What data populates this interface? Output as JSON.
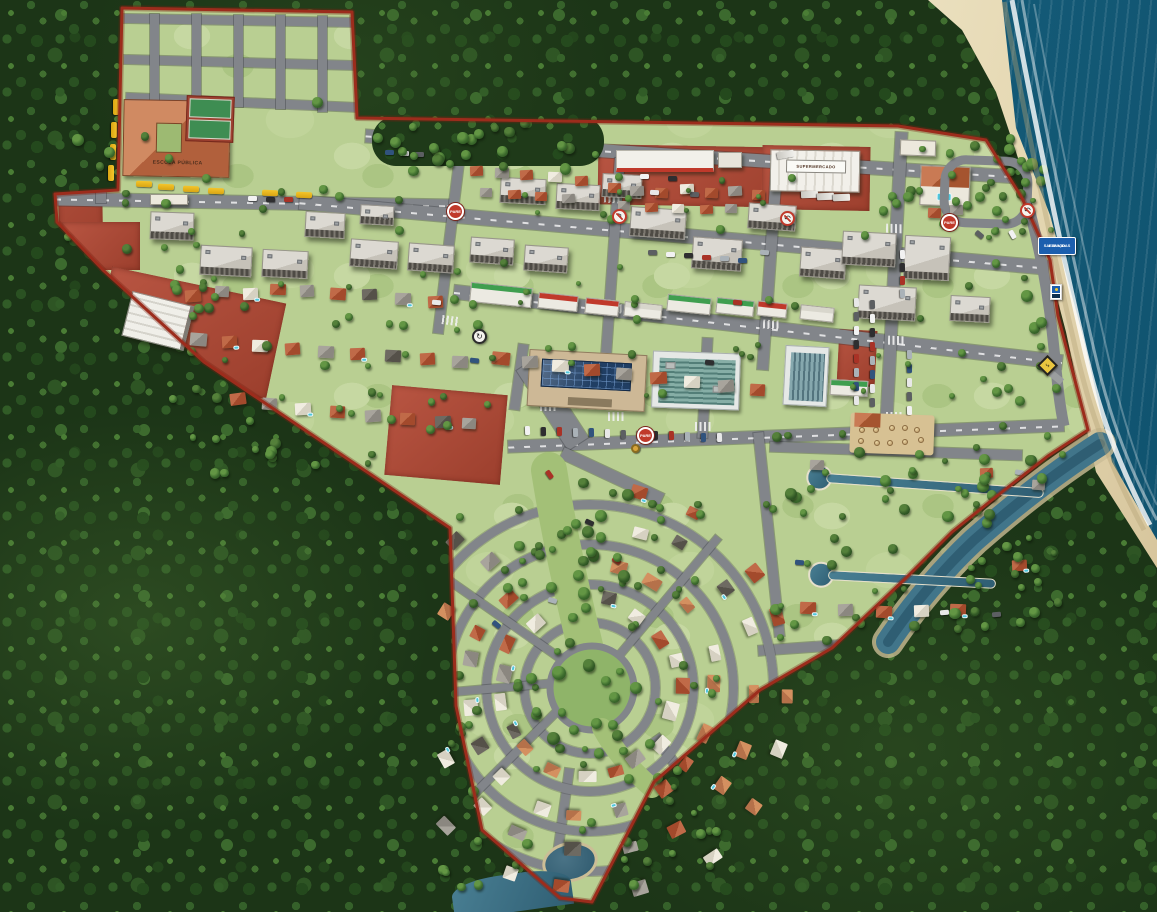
{
  "meta": {
    "description": "Aerial 3D masterplan rendering of a coastal planned neighborhood bounded by a red property line, surrounded by dense forest, with a beach and ocean on the right and a river mouth to the southeast.",
    "width": 1157,
    "height": 912
  },
  "palette": {
    "forest": "#1c3517",
    "lawn": "#b9cf92",
    "road": "#82858a",
    "boundary": "#9c2c1c",
    "red_lot": "#ad4a37",
    "ocean": "#1d6e88",
    "sand": "#e2d6b0",
    "water": "#3c7086",
    "stop_red": "#c0392b",
    "info_blue": "#1c5fae",
    "warning_yellow": "#e9c53f",
    "bus_yellow": "#f4c52b",
    "solar_blue": "#203e63"
  },
  "labels": {
    "school_roof": "ESCOLA PÚBLICA",
    "market_roof": "SUPERMERCADO",
    "stop_sign": "PARE",
    "beach_info_line1": "ESPAÇO",
    "beach_info_line2": "SALVA-VIDAS"
  },
  "icons": {
    "no_left_turn": "↰",
    "no_u_turn": "↶",
    "roundabout": "↻",
    "beach_warning": "⤷"
  },
  "map": {
    "roof_colors": [
      [
        "#c06a48",
        "#a34a2c"
      ],
      [
        "#a8a49c",
        "#8b8780"
      ],
      [
        "#f0ece0",
        "#d6d1c2"
      ],
      [
        "#6e6a62",
        "#555149"
      ],
      [
        "#d49060",
        "#b5714a"
      ]
    ],
    "car_colors": [
      "#f2f2f2",
      "#2e2e30",
      "#a93226",
      "#aab2b8",
      "#31537d",
      "#e8e8e8",
      "#5c5f62"
    ],
    "shop_sign_colors": {
      "g": "#3f9e4f",
      "r": "#c0392b",
      "w": "#d8d6cc"
    },
    "red_lots": [
      [
        598,
        146,
        206,
        60,
        1
      ],
      [
        762,
        146,
        108,
        64,
        1
      ],
      [
        58,
        94,
        44,
        170,
        -1
      ],
      [
        62,
        222,
        78,
        48,
        0
      ],
      [
        100,
        284,
        178,
        98,
        12
      ],
      [
        388,
        390,
        116,
        90,
        5
      ],
      [
        838,
        330,
        38,
        56,
        3
      ]
    ],
    "roads": [
      [
        124,
        16,
        230,
        9,
        1,
        0
      ],
      [
        124,
        58,
        232,
        9,
        1.5,
        0
      ],
      [
        126,
        98,
        236,
        9,
        2.5,
        0
      ],
      [
        55,
        196,
        398,
        13,
        1,
        1
      ],
      [
        150,
        14,
        9,
        92,
        0,
        0
      ],
      [
        192,
        14,
        9,
        92,
        0,
        0
      ],
      [
        234,
        15,
        9,
        92,
        0,
        0
      ],
      [
        276,
        15,
        9,
        94,
        0,
        0
      ],
      [
        318,
        16,
        9,
        96,
        0,
        0
      ],
      [
        96,
        95,
        10,
        108,
        0,
        0
      ],
      [
        365,
        150,
        655,
        13,
        3.6,
        1
      ],
      [
        298,
        228,
        752,
        14,
        5,
        1
      ],
      [
        452,
        320,
        612,
        14,
        6.6,
        1
      ],
      [
        508,
        430,
        556,
        12,
        -2.2,
        1
      ],
      [
        444,
        154,
        10,
        180,
        7,
        0
      ],
      [
        608,
        158,
        10,
        196,
        4,
        0
      ],
      [
        764,
        172,
        11,
        198,
        4,
        0
      ],
      [
        888,
        132,
        12,
        290,
        3,
        0
      ],
      [
        700,
        338,
        10,
        100,
        3,
        0
      ],
      [
        514,
        344,
        10,
        66,
        8,
        0
      ],
      [
        505,
        392,
        95,
        24,
        57,
        0
      ],
      [
        557,
        470,
        110,
        12,
        25,
        0
      ],
      [
        636,
        768,
        90,
        10,
        55,
        0
      ],
      [
        558,
        768,
        9,
        100,
        8,
        0
      ],
      [
        770,
        446,
        252,
        10,
        2,
        0
      ],
      [
        758,
        636,
        280,
        10,
        -4,
        0
      ],
      [
        764,
        432,
        10,
        205,
        -6,
        0
      ],
      [
        1026,
        522,
        9,
        95,
        10,
        0
      ]
    ],
    "ring_roads": [
      [
        590,
        688,
        70
      ],
      [
        590,
        688,
        108
      ],
      [
        590,
        688,
        148
      ],
      [
        590,
        688,
        188
      ]
    ],
    "spoke_roads": [
      [
        135,
        195
      ],
      [
        175,
        195
      ],
      [
        215,
        195
      ],
      [
        310,
        195
      ]
    ],
    "crosswalks": [
      [
        447,
        206,
        7
      ],
      [
        604,
        194,
        4
      ],
      [
        762,
        210,
        4
      ],
      [
        886,
        224,
        3
      ],
      [
        442,
        316,
        7
      ],
      [
        606,
        304,
        4
      ],
      [
        763,
        320,
        4
      ],
      [
        888,
        336,
        3
      ],
      [
        540,
        402,
        0
      ],
      [
        608,
        412,
        0
      ],
      [
        695,
        422,
        0
      ],
      [
        886,
        412,
        0
      ]
    ],
    "apartments": [
      [
        150,
        212,
        44,
        28,
        2
      ],
      [
        200,
        246,
        52,
        30,
        3
      ],
      [
        262,
        250,
        46,
        28,
        3
      ],
      [
        305,
        212,
        40,
        26,
        3
      ],
      [
        360,
        205,
        34,
        20,
        3
      ],
      [
        350,
        240,
        48,
        28,
        4
      ],
      [
        408,
        244,
        46,
        28,
        4
      ],
      [
        470,
        238,
        44,
        26,
        4
      ],
      [
        524,
        246,
        44,
        26,
        4
      ],
      [
        500,
        178,
        46,
        26,
        3
      ],
      [
        556,
        184,
        44,
        26,
        3
      ],
      [
        602,
        174,
        40,
        24,
        3
      ],
      [
        630,
        208,
        56,
        30,
        4
      ],
      [
        692,
        238,
        50,
        32,
        4
      ],
      [
        748,
        204,
        48,
        26,
        4
      ],
      [
        800,
        248,
        46,
        30,
        4
      ],
      [
        842,
        232,
        54,
        34,
        3
      ],
      [
        904,
        236,
        46,
        44,
        3
      ],
      [
        858,
        286,
        58,
        34,
        3
      ],
      [
        950,
        296,
        40,
        26,
        3
      ]
    ],
    "shops": [
      [
        470,
        285,
        62,
        20,
        6,
        "g"
      ],
      [
        538,
        294,
        40,
        16,
        6,
        "r"
      ],
      [
        585,
        299,
        34,
        16,
        6,
        "r"
      ],
      [
        624,
        303,
        38,
        15,
        6,
        "w"
      ],
      [
        667,
        296,
        44,
        17,
        6,
        "g"
      ],
      [
        716,
        299,
        38,
        16,
        6,
        "g"
      ],
      [
        757,
        302,
        30,
        15,
        6,
        "r"
      ],
      [
        800,
        306,
        34,
        15,
        6,
        "w"
      ],
      [
        830,
        380,
        38,
        16,
        3,
        "g"
      ]
    ],
    "houses": [
      [
        608,
        183,
        13,
        10,
        0,
        2,
        0
      ],
      [
        630,
        186,
        14,
        10,
        1,
        -2,
        0
      ],
      [
        655,
        188,
        13,
        10,
        0,
        3,
        0
      ],
      [
        680,
        184,
        14,
        10,
        2,
        -2,
        0
      ],
      [
        705,
        188,
        13,
        10,
        0,
        2,
        0
      ],
      [
        728,
        186,
        14,
        10,
        1,
        -3,
        0
      ],
      [
        752,
        190,
        13,
        10,
        0,
        2,
        0
      ],
      [
        618,
        201,
        12,
        9,
        1,
        2,
        0
      ],
      [
        645,
        203,
        13,
        9,
        0,
        -2,
        0
      ],
      [
        672,
        204,
        12,
        9,
        2,
        2,
        0
      ],
      [
        700,
        205,
        13,
        9,
        0,
        -2,
        0
      ],
      [
        725,
        204,
        12,
        9,
        1,
        2,
        0
      ],
      [
        470,
        166,
        13,
        10,
        0,
        -2,
        0
      ],
      [
        495,
        168,
        14,
        10,
        1,
        2,
        0
      ],
      [
        520,
        170,
        13,
        10,
        0,
        -3,
        0
      ],
      [
        548,
        172,
        14,
        10,
        2,
        2,
        0
      ],
      [
        575,
        176,
        13,
        10,
        0,
        -2,
        0
      ],
      [
        480,
        188,
        12,
        9,
        1,
        2,
        0
      ],
      [
        508,
        190,
        13,
        9,
        0,
        -2,
        0
      ],
      [
        535,
        192,
        12,
        9,
        0,
        2,
        0
      ],
      [
        562,
        194,
        13,
        9,
        1,
        -2,
        0
      ],
      [
        185,
        290,
        16,
        12,
        0,
        -4,
        0
      ],
      [
        215,
        286,
        14,
        11,
        1,
        3,
        0
      ],
      [
        243,
        288,
        15,
        12,
        2,
        -2,
        1
      ],
      [
        270,
        284,
        16,
        11,
        0,
        2,
        0
      ],
      [
        300,
        285,
        14,
        12,
        1,
        -3,
        0
      ],
      [
        330,
        288,
        16,
        12,
        0,
        4,
        0
      ],
      [
        362,
        289,
        15,
        11,
        3,
        -2,
        0
      ],
      [
        395,
        293,
        16,
        12,
        1,
        2,
        1
      ],
      [
        428,
        296,
        15,
        12,
        0,
        -3,
        0
      ],
      [
        190,
        333,
        17,
        13,
        1,
        5,
        0
      ],
      [
        222,
        336,
        15,
        12,
        0,
        -3,
        1
      ],
      [
        252,
        340,
        16,
        12,
        2,
        2,
        0
      ],
      [
        285,
        343,
        15,
        12,
        0,
        -4,
        0
      ],
      [
        318,
        346,
        16,
        12,
        1,
        3,
        0
      ],
      [
        350,
        348,
        15,
        12,
        0,
        -2,
        1
      ],
      [
        385,
        350,
        16,
        12,
        3,
        3,
        0
      ],
      [
        420,
        353,
        15,
        12,
        0,
        -3,
        0
      ],
      [
        452,
        356,
        16,
        12,
        1,
        2,
        0
      ],
      [
        230,
        393,
        16,
        12,
        0,
        -8,
        0
      ],
      [
        262,
        398,
        15,
        12,
        1,
        4,
        0
      ],
      [
        295,
        403,
        16,
        12,
        2,
        -3,
        1
      ],
      [
        330,
        406,
        15,
        12,
        0,
        3,
        0
      ],
      [
        365,
        410,
        16,
        12,
        1,
        -4,
        0
      ],
      [
        400,
        413,
        15,
        12,
        0,
        2,
        0
      ],
      [
        435,
        416,
        16,
        12,
        3,
        -2,
        1
      ],
      [
        462,
        418,
        14,
        11,
        1,
        3,
        0
      ],
      [
        492,
        352,
        18,
        13,
        0,
        6,
        0
      ],
      [
        522,
        356,
        16,
        12,
        1,
        -3,
        0
      ],
      [
        552,
        360,
        17,
        12,
        2,
        3,
        1
      ],
      [
        584,
        364,
        16,
        12,
        0,
        -2,
        0
      ],
      [
        616,
        368,
        16,
        12,
        1,
        4,
        0
      ],
      [
        650,
        372,
        17,
        12,
        0,
        -3,
        0
      ],
      [
        684,
        376,
        16,
        12,
        2,
        2,
        0
      ],
      [
        718,
        380,
        16,
        12,
        1,
        -4,
        0
      ],
      [
        750,
        384,
        15,
        12,
        0,
        3,
        0
      ],
      [
        810,
        460,
        14,
        10,
        1,
        2,
        0
      ],
      [
        980,
        468,
        13,
        10,
        0,
        -2,
        0
      ],
      [
        1032,
        480,
        13,
        10,
        1,
        4,
        0
      ],
      [
        800,
        602,
        16,
        12,
        0,
        2,
        1
      ],
      [
        838,
        604,
        15,
        12,
        1,
        -2,
        0
      ],
      [
        876,
        606,
        16,
        12,
        0,
        3,
        1
      ],
      [
        914,
        605,
        15,
        12,
        2,
        -2,
        0
      ],
      [
        950,
        604,
        16,
        12,
        0,
        2,
        1
      ],
      [
        1012,
        560,
        15,
        11,
        0,
        -3,
        1
      ],
      [
        928,
        208,
        13,
        10,
        0,
        2,
        0
      ],
      [
        950,
        205,
        13,
        10,
        1,
        -2,
        0
      ]
    ],
    "arc_housing": {
      "cx": 590,
      "cy": 688,
      "radii": [
        88,
        126,
        166,
        204
      ],
      "step": 19,
      "skip_from": 243,
      "skip_to": 282,
      "seed": 7
    },
    "tree_zones": [
      [
        58,
        86,
        300,
        132,
        12,
        7,
        12,
        11
      ],
      [
        168,
        265,
        305,
        205,
        55,
        6,
        11,
        22
      ],
      [
        455,
        162,
        595,
        245,
        55,
        5,
        9,
        33
      ],
      [
        438,
        478,
        275,
        405,
        85,
        6,
        11,
        44
      ],
      [
        545,
        474,
        86,
        290,
        26,
        8,
        14,
        55
      ],
      [
        758,
        428,
        305,
        215,
        70,
        6,
        12,
        66
      ],
      [
        878,
        133,
        145,
        100,
        18,
        6,
        11,
        77
      ],
      [
        986,
        146,
        78,
        298,
        24,
        7,
        12,
        88
      ],
      [
        372,
        118,
        230,
        48,
        24,
        7,
        12,
        99
      ],
      [
        60,
        190,
        390,
        55,
        10,
        6,
        10,
        13
      ]
    ],
    "car_rows": [
      [
        523,
        428,
        13,
        16,
        0.6,
        1
      ],
      [
        648,
        250,
        6,
        18,
        1.6,
        0
      ],
      [
        852,
        300,
        8,
        0,
        14,
        1
      ],
      [
        868,
        302,
        8,
        0,
        14,
        1
      ],
      [
        898,
        252,
        4,
        0,
        13,
        1
      ],
      [
        385,
        150,
        3,
        15,
        1,
        0
      ],
      [
        248,
        196,
        3,
        18,
        0.5,
        0
      ],
      [
        905,
        352,
        5,
        0,
        14,
        1
      ]
    ],
    "cars": [
      [
        705,
        360,
        5
      ],
      [
        733,
        300,
        4
      ],
      [
        760,
        250,
        4
      ],
      [
        470,
        358,
        6
      ],
      [
        432,
        300,
        5
      ],
      [
        975,
        232,
        40
      ],
      [
        1008,
        232,
        60
      ],
      [
        585,
        520,
        25
      ],
      [
        612,
        558,
        35
      ],
      [
        548,
        598,
        15
      ],
      [
        492,
        622,
        40
      ],
      [
        650,
        190,
        3
      ],
      [
        690,
        192,
        2
      ],
      [
        640,
        174,
        0
      ],
      [
        668,
        176,
        0
      ],
      [
        545,
        472,
        55
      ],
      [
        1015,
        470,
        10
      ],
      [
        795,
        560,
        4
      ],
      [
        940,
        610,
        -4
      ],
      [
        992,
        612,
        -4
      ]
    ],
    "buses": [
      [
        108,
        104,
        90
      ],
      [
        106,
        127,
        90
      ],
      [
        105,
        149,
        90
      ],
      [
        103,
        170,
        90
      ],
      [
        136,
        181,
        2
      ],
      [
        158,
        184,
        2
      ],
      [
        183,
        186,
        2
      ],
      [
        208,
        188,
        2
      ],
      [
        262,
        190,
        2
      ],
      [
        296,
        192,
        2
      ]
    ],
    "trucks": [
      [
        806,
        186,
        88
      ],
      [
        822,
        188,
        88
      ],
      [
        838,
        189,
        88
      ],
      [
        782,
        146,
        80
      ]
    ],
    "umbrellas": {
      "x": 858,
      "y": 424,
      "cols": 5,
      "rows": 2,
      "dx": 14,
      "dy": 13
    }
  }
}
